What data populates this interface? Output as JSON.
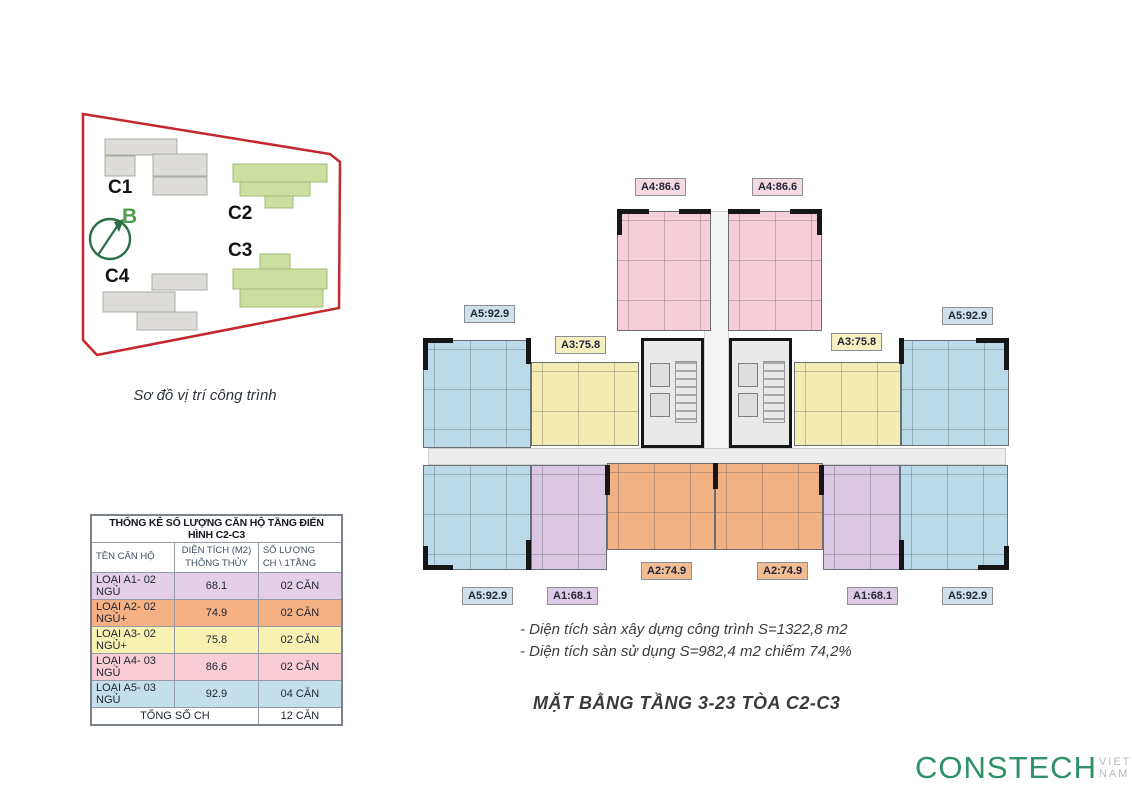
{
  "site_diagram": {
    "caption": "Sơ đồ vị trí công trình",
    "compass_label": "B",
    "building_labels": [
      "C1",
      "C2",
      "C3",
      "C4"
    ],
    "boundary_color": "#c4272e",
    "highlight_color": "#cddfa0",
    "neutral_color": "#dddcd8",
    "compass_color": "#2c6e46",
    "compass_label_color": "#4a9e4f"
  },
  "stats_table": {
    "title": "THỐNG KÊ SỐ LƯỢNG CĂN HỘ TẦNG ĐIỂN HÌNH C2-C3",
    "col_name": "TÊN CĂN HỘ",
    "col_area": "DIỆN TÍCH (M2)\nTHÔNG THỦY",
    "col_count": "SỐ LƯỢNG\nCH \\ 1TẦNG",
    "rows": [
      {
        "name": "LOẠI A1- 02 NGỦ",
        "area": "68.1",
        "count": "02 CĂN",
        "color": "#e3cfe7"
      },
      {
        "name": "LOẠI A2- 02 NGỦ+",
        "area": "74.9",
        "count": "02 CĂN",
        "color": "#f5b183"
      },
      {
        "name": "LOẠI A3- 02 NGỦ+",
        "area": "75.8",
        "count": "02 CĂN",
        "color": "#f8f2b2"
      },
      {
        "name": "LOẠI A4- 03 NGỦ",
        "area": "86.6",
        "count": "02 CĂN",
        "color": "#f8cdd6"
      },
      {
        "name": "LOẠI A5- 03 NGỦ",
        "area": "92.9",
        "count": "04 CĂN",
        "color": "#c4e0ee"
      }
    ],
    "total_label": "TỔNG SỐ CH",
    "total_value": "12 CĂN"
  },
  "plan": {
    "unit_labels": [
      {
        "text": "A4:86.6"
      },
      {
        "text": "A4:86.6"
      },
      {
        "text": "A5:92.9"
      },
      {
        "text": "A3:75.8"
      },
      {
        "text": "A3:75.8"
      },
      {
        "text": "A5:92.9"
      },
      {
        "text": "A2:74.9"
      },
      {
        "text": "A2:74.9"
      },
      {
        "text": "A5:92.9"
      },
      {
        "text": "A1:68.1"
      },
      {
        "text": "A1:68.1"
      },
      {
        "text": "A5:92.9"
      }
    ],
    "notes": [
      "- Diện tích sàn xây dựng công trình S=1322,8 m2",
      "- Diện tích sàn sử dụng S=982,4 m2 chiếm 74,2%"
    ],
    "title": "MẶT BẰNG TẦNG 3-23 TÒA C2-C3"
  },
  "colors": {
    "a1": "#d9c7e3",
    "a2": "#f2b183",
    "a3": "#f4edb2",
    "a4": "#f6ced8",
    "a5": "#bad9e9",
    "core": "#e9e9e9",
    "corridor": "#ededed",
    "label_a1": "#ddcbe6",
    "label_a2": "#f3bd92",
    "label_a3": "#f6f0c0",
    "label_a4": "#f5dbe1",
    "label_a5": "#cfe0ea",
    "logo_green": "#2f9168"
  },
  "logo": {
    "brand": "CONSTECH",
    "suffix": "VIET NAM"
  }
}
